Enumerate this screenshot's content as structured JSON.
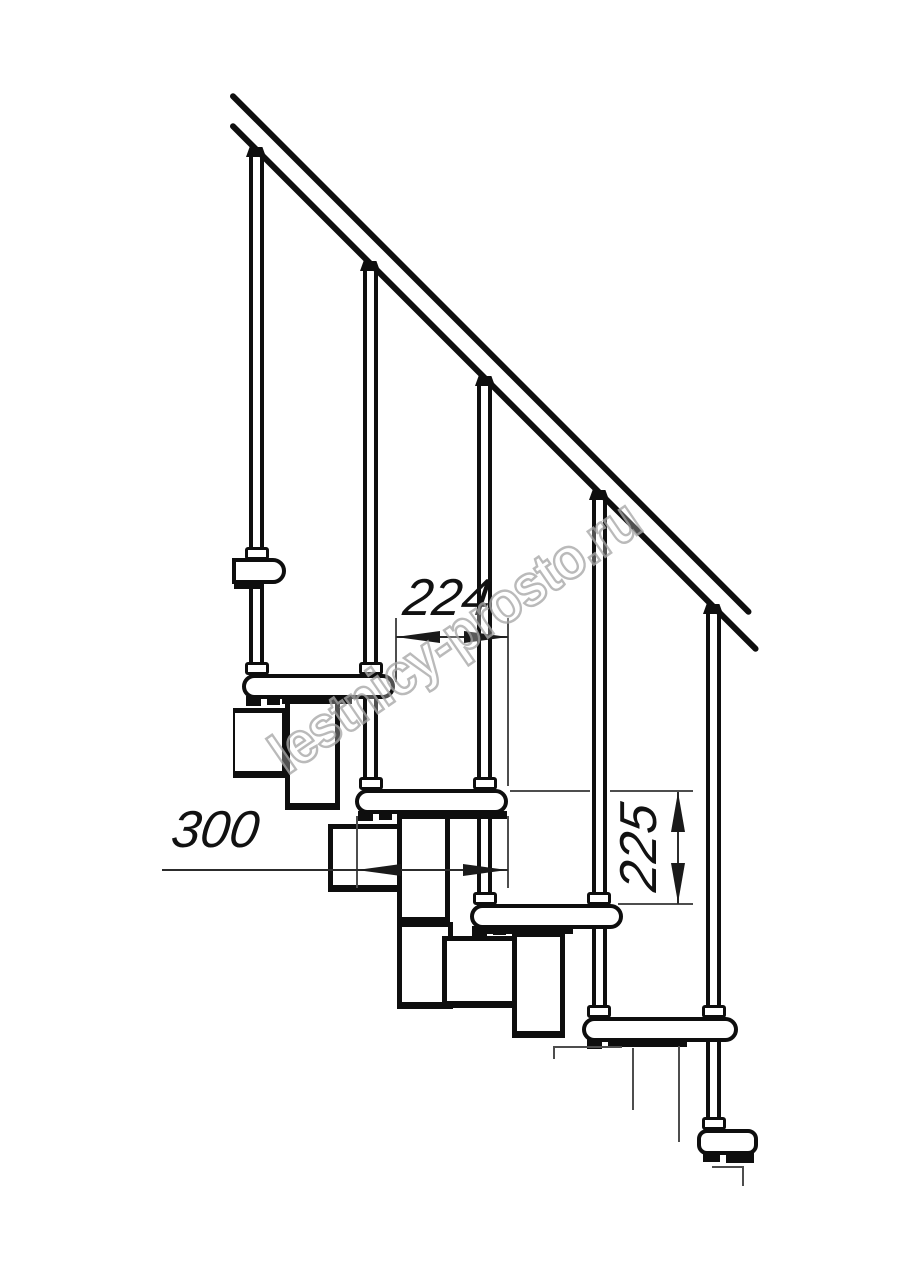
{
  "meta": {
    "description": "Side-view technical line drawing of a modular staircase: diagonal handrail, five balusters, five treads with module blocks, and three dimension callouts"
  },
  "watermark": {
    "text": "lestnicy-prosto.ru"
  },
  "dimensions": {
    "run_between_steps": "224",
    "tread_depth": "300",
    "step_rise": "225"
  },
  "colors": {
    "background": "#ffffff",
    "drawing_line": "#0e0e0e",
    "dimension_line": "#2c2c2c",
    "watermark_outline": "#a9a9a9"
  }
}
